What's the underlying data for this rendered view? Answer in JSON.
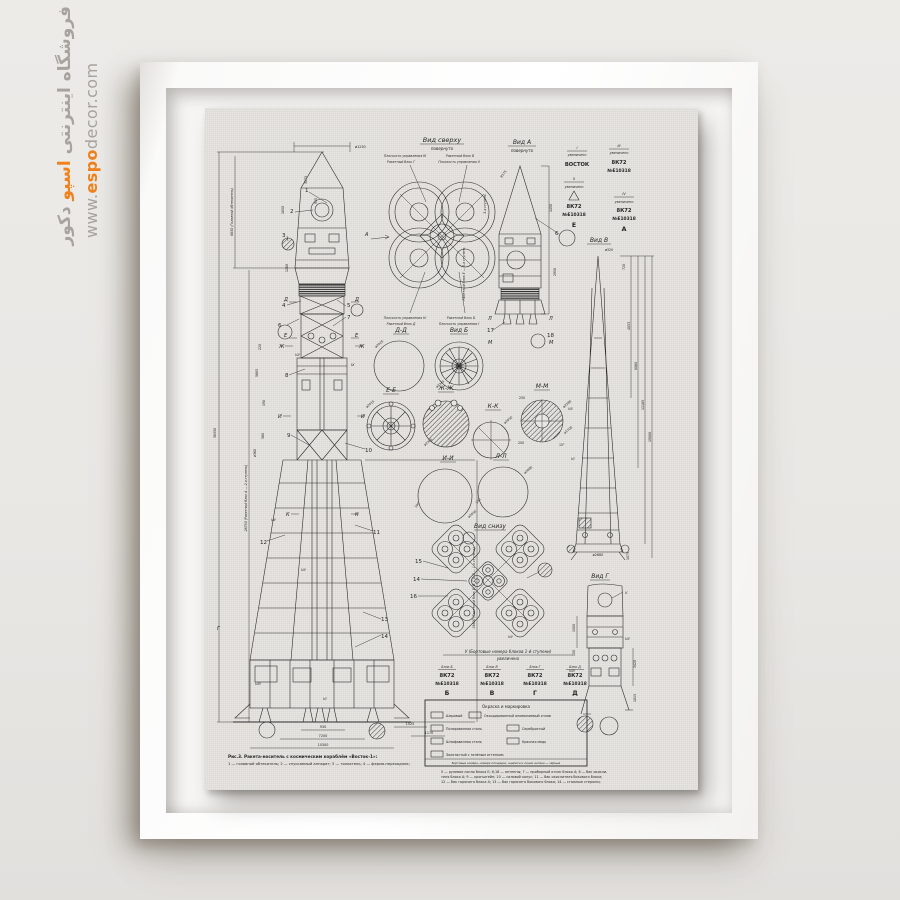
{
  "watermark": {
    "store_fa_pre": "فروشگاه اینترنتی",
    "store_fa_brand": "اسپو",
    "store_fa_post": "دکور",
    "url_www": "www.",
    "url_brand": "espo",
    "url_rest": "decor.com",
    "accent_color": "#f0821e",
    "gray_color": "#a7a39f"
  },
  "drawing": {
    "titles": {
      "top_view": "Вид сверху",
      "rotated": "повернуто",
      "view_a": "Вид А",
      "view_b": "Вид В",
      "view_g": "Вид Г",
      "bottom_view": "Вид снизу"
    },
    "plane": {
      "t1": "Плоскость управления III",
      "t2": "Ракетный блок В",
      "t3": "Ракетный блок Г",
      "t4": "Плоскость управления II",
      "b1": "Плоскость управления IV",
      "b2": "Ракетный блок Б",
      "b3": "Ракетный блок Д",
      "b4": "Плоскость управления I"
    },
    "rot_notes": {
      "stage3": "3-я ступень",
      "block_e": "Ракетный блок Е — 3-я ступень",
      "len_total": "38350",
      "len_fairing": "6650 (Головной обтекатель)",
      "len_stage2": "28750 (Ракетный блок А — 2-я ступень)",
      "len_stage1": "19800 (Ракетный блок Б, В, Г и Д — 1-я ступень)"
    },
    "sections": {
      "dd": "Д-Д",
      "vid_b": "Вид Б",
      "ee": "Е-Е",
      "zhzh": "Ж-Ж",
      "kk": "К-К",
      "mm": "М-М",
      "ii": "И-И",
      "ll": "Л-Л"
    },
    "stamps": {
      "s1": "I",
      "s2": "II",
      "s3": "III",
      "s4": "IV",
      "enl": "увеличено",
      "vostok": "ВОСТОК",
      "code": "8К72",
      "serial": "№Е10318",
      "se": "Е",
      "sa": "А"
    },
    "tableV": {
      "title": "V (Бортовые номера блоков 1-й ступени)",
      "sub": "увеличено",
      "cols": [
        {
          "head": "Блок Б",
          "code": "8К72",
          "num": "№Е10318",
          "lt": "Б"
        },
        {
          "head": "Блок В",
          "code": "8К72",
          "num": "№Е10318",
          "lt": "В"
        },
        {
          "head": "Блок Г",
          "code": "8К72",
          "num": "№Е10318",
          "lt": "Г"
        },
        {
          "head": "Блок Д",
          "code": "8К72",
          "num": "№Е10318",
          "lt": "Д"
        }
      ]
    },
    "legend": {
      "title": "Окраска и маркировка",
      "i1": "Шаровый",
      "i2": "Оксидированный алюминиевый сплав",
      "i3": "Полированная сталь",
      "i4": "Серебристый",
      "i5": "Шлифованная сталь",
      "i6": "Красная медь",
      "i7": "Золотистый с зелёным оттенком",
      "note": "Бортовые номера, номера площадок, надписи и линии антенн — чёрные"
    },
    "captions": {
      "t1": "Рис.3. Ракета-носитель с космическим кораблём «Восток-1»:",
      "t2": "1 — головной обтекатель; 2 — спускаемый аппарат; 3 — толкатель; 4 — ферма-переходник;",
      "r1": "5 — рулевое сопло блока Е; 6,18 — антенны; 7 — приборный отсек блока А; 8 — бак окисли-",
      "r2": "теля блока А; 9 — кронштейн; 10 — силовой конус; 11 — бак окислителя бокового блока;",
      "r3": "12 — бак горючего блока А; 13 — бак горючего бокового блока; 14 — стяжные стержни;",
      "r4": "15 — двигатель РД-108; 16 — двигатель РД-107; 17 — двигатель РО-7;",
      "r5": "VI — заклёпочный шов (заклёпки с потайной головкой); VII — шов точечной сварки; VIII —",
      "r6": "заклёпочный шов (заклёпки с полусферической головкой); IX — сварной шов"
    },
    "dims": {
      "d1230": "ø1230",
      "d3075": "3075",
      "d935": "935",
      "d1850": "1850",
      "d1260": "1260",
      "d220": "220",
      "d5685": "5685",
      "d190": "190",
      "d560": "560",
      "d360": "ø360",
      "d930": "930",
      "d7200": "7200",
      "d10300": "10300",
      "d1170": "1170",
      "d1025": "1025",
      "d320": "ø320",
      "d720": "720",
      "d4053": "4053",
      "d8060": "8060",
      "d11165": "11165",
      "d19080": "19080",
      "d1075": "1075",
      "d2680": "ø2680",
      "d1450": "1450",
      "d2950": "2950",
      "dR175": "R175",
      "d2420": "ø2420",
      "d2345": "ø2345",
      "d2415": "ø2415",
      "d2385": "ø2385",
      "d2050": "ø2050",
      "d2080": "ø2080",
      "d2580": "ø2580",
      "d1700": "ø1700",
      "d250": "250",
      "d200": "200",
      "d130": "130",
      "d150": "150",
      "d1500": "1500",
      "d3420": "3420",
      "d1015": "1015",
      "d15deg": "15°"
    },
    "callouts": {
      "c1": "1",
      "c2": "2",
      "c3": "3",
      "c4": "4",
      "c5": "5",
      "c6": "6",
      "c7": "7",
      "c8": "8",
      "c9": "9",
      "c10": "10",
      "c11": "11",
      "c12": "12",
      "c13": "13",
      "c14": "14",
      "c15": "15",
      "c16": "16",
      "c17": "17",
      "c18": "18"
    },
    "romans": {
      "r5": "V",
      "r6": "VI",
      "r7": "VII",
      "r8": "VIII",
      "r9": "IX"
    },
    "letters": {
      "ld": "Д",
      "le": "Е",
      "lzh": "Ж",
      "li": "И",
      "lk": "К",
      "lg": "Г",
      "ll": "Л",
      "lm": "М",
      "la": "А"
    }
  }
}
